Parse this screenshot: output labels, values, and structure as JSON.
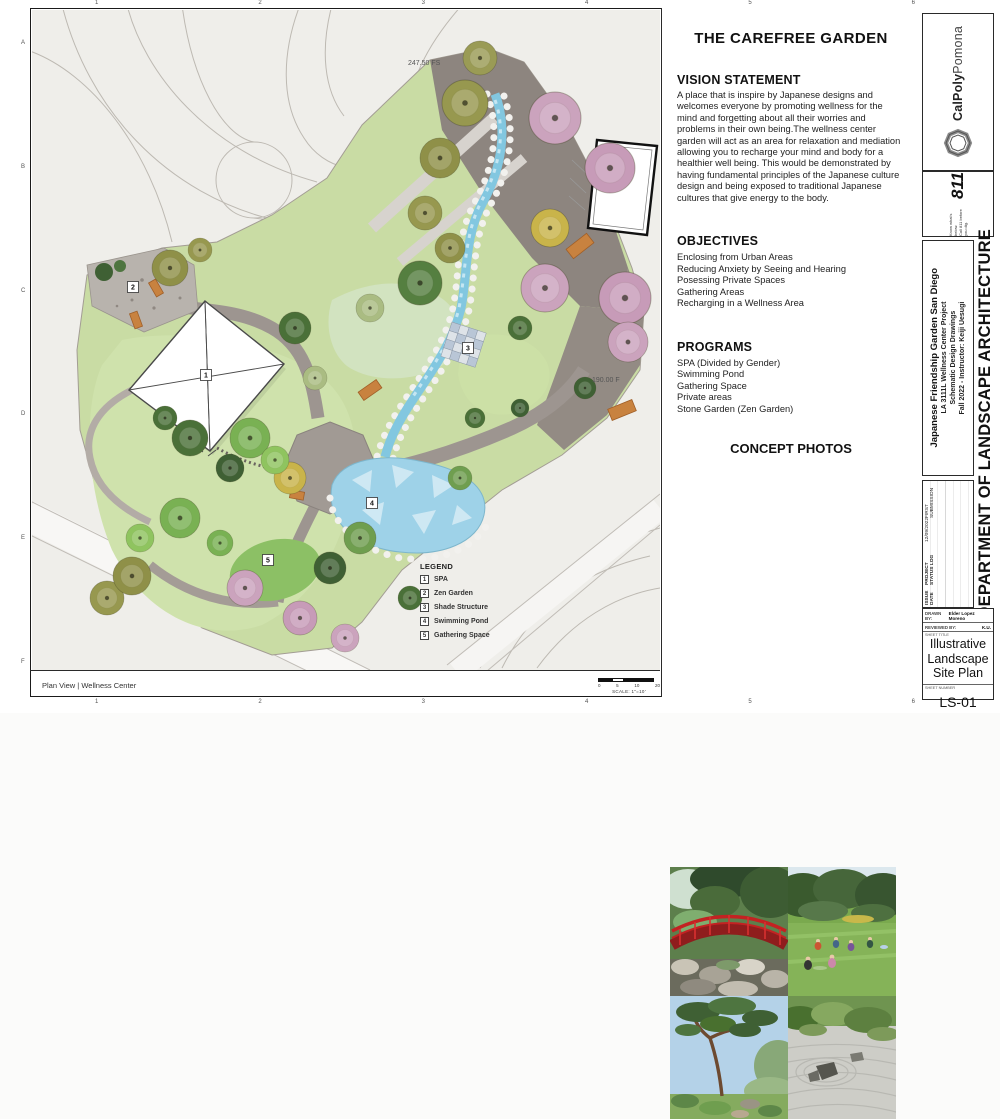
{
  "panel": {
    "title": "THE CAREFREE GARDEN",
    "vision_heading": "VISION STATEMENT",
    "vision_text": "A place that is inspire by Japanese designs and welcomes everyone by promoting wellness for the mind and forgetting about all their worries and problems in their own being.The wellness center garden will act as an area for relaxation and mediation allowing you to recharge your mind and body for a healthier well being. This would be demonstrated by having fundamental principles of the Japanese culture design and being exposed to traditional Japanese cultures that give energy to the body.",
    "objectives_heading": "OBJECTIVES",
    "objectives": [
      "Enclosing from Urban Areas",
      "Reducing Anxiety by Seeing and Hearing",
      "Posessing Private Spaces",
      "Gathering Areas",
      "Recharging in a Wellness Area"
    ],
    "programs_heading": "PROGRAMS",
    "programs": [
      "SPA (Divided by Gender)",
      "Swimming Pond",
      "Gathering Space",
      "Private areas",
      "Stone Garden (Zen Garden)"
    ],
    "photos_heading": "CONCEPT PHOTOS",
    "photo_names": [
      "red bridge over stream",
      "meditation on lawn",
      "japanese pine tree",
      "zen rock garden"
    ]
  },
  "plan": {
    "view_label": "Plan View | Wellness Center",
    "elev_top": "247.50 FS",
    "elev_right": "190.00 F",
    "scale_note": "SCALE: 1\"=10'",
    "scale_ticks": [
      "0",
      "5",
      "10",
      "20"
    ],
    "north_glyph": "▲",
    "legend_title": "LEGEND",
    "legend": [
      {
        "num": "1",
        "label": "SPA"
      },
      {
        "num": "2",
        "label": "Zen Garden"
      },
      {
        "num": "3",
        "label": "Shade Structure"
      },
      {
        "num": "4",
        "label": "Swimming Pond"
      },
      {
        "num": "5",
        "label": "Gathering Space"
      }
    ],
    "markers": [
      {
        "num": "1"
      },
      {
        "num": "2"
      },
      {
        "num": "3"
      },
      {
        "num": "4"
      },
      {
        "num": "5"
      }
    ],
    "grid_letters": [
      "A",
      "B",
      "C",
      "D",
      "E",
      "F"
    ],
    "grid_numbers": [
      "1",
      "2",
      "3",
      "4",
      "5",
      "6"
    ]
  },
  "titleblock": {
    "calpoly_bold": "CalPoly",
    "calpoly_light": "Pomona",
    "dig_number": "811",
    "dig_line1": "Know what's below.",
    "dig_line2": "Call 811 before you dig.",
    "project_line1": "Japanese Friendship Garden San Diego",
    "project_lines": [
      "LA 3111L Wellness Center Project",
      "Schematic Design Drawings",
      "Fall 2022 - Instructor: Keiji Uesugi"
    ],
    "department": "DEPARTMENT OF LANDSCAPE ARCHITECTURE",
    "log_col_date": "ISSUE DATE",
    "log_col_status": "PROJECT STATUS LOG",
    "log_row_date": "12/09/2022",
    "log_row_status": "FIRST SUBMISSION",
    "drawn_by_label": "DRAWN BY:",
    "drawn_by": "Elder Lopez Moreno",
    "reviewed_by_label": "REVIEWED BY:",
    "reviewed_by": "K.U.",
    "sheet_title_label": "SHEET TITLE",
    "sheet_title": "Illustrative Landscape Site Plan",
    "sheet_number_label": "SHEET NUMBER",
    "sheet_number": "LS-01"
  },
  "colors": {
    "accent_bridge_red": "#c32222",
    "water_blue": "#82c7e0",
    "lawn_green": "#c9dca4",
    "path_gray": "#9d9590"
  }
}
